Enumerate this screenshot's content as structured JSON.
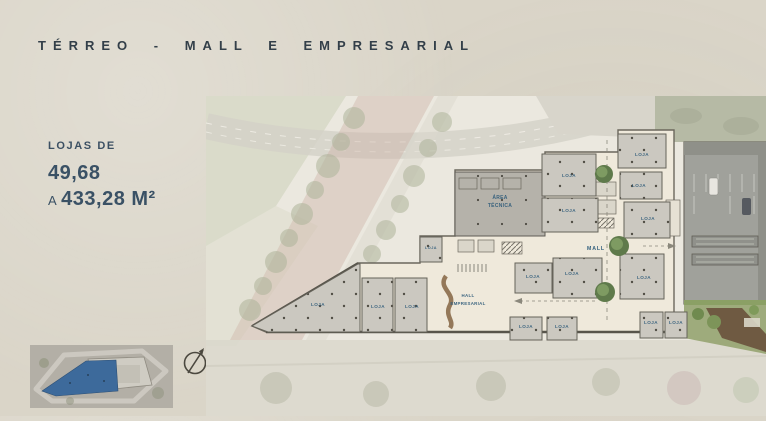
{
  "page": {
    "title": "TÉRREO - MALL E EMPRESARIAL",
    "background_color": "#dad5c8",
    "title_color": "#333f49"
  },
  "info_panel": {
    "label": "LOJAS DE",
    "min_value": "49,68",
    "range_prefix": "A",
    "max_value": "433,28 M²",
    "text_color": "#3a5165"
  },
  "minimap": {
    "highlight_color": "#3d6a9b"
  },
  "plan": {
    "label_color": "#2f5b7a",
    "labels": {
      "loja": "LOJA",
      "mall": "MALL",
      "area_tecnica_line1": "ÁREA",
      "area_tecnica_line2": "TÉCNICA",
      "hall_line1": "HALL",
      "hall_line2": "EMPRESARIAL"
    },
    "loja_positions": [
      {
        "x": 436,
        "y": 60
      },
      {
        "x": 433,
        "y": 91
      },
      {
        "x": 442,
        "y": 124
      },
      {
        "x": 363,
        "y": 81
      },
      {
        "x": 363,
        "y": 116
      },
      {
        "x": 225,
        "y": 153,
        "small": true
      },
      {
        "x": 327,
        "y": 182
      },
      {
        "x": 366,
        "y": 179
      },
      {
        "x": 112,
        "y": 210
      },
      {
        "x": 172,
        "y": 212
      },
      {
        "x": 206,
        "y": 212
      },
      {
        "x": 320,
        "y": 232
      },
      {
        "x": 356,
        "y": 232
      },
      {
        "x": 438,
        "y": 183
      },
      {
        "x": 445,
        "y": 228
      },
      {
        "x": 470,
        "y": 228
      }
    ]
  }
}
